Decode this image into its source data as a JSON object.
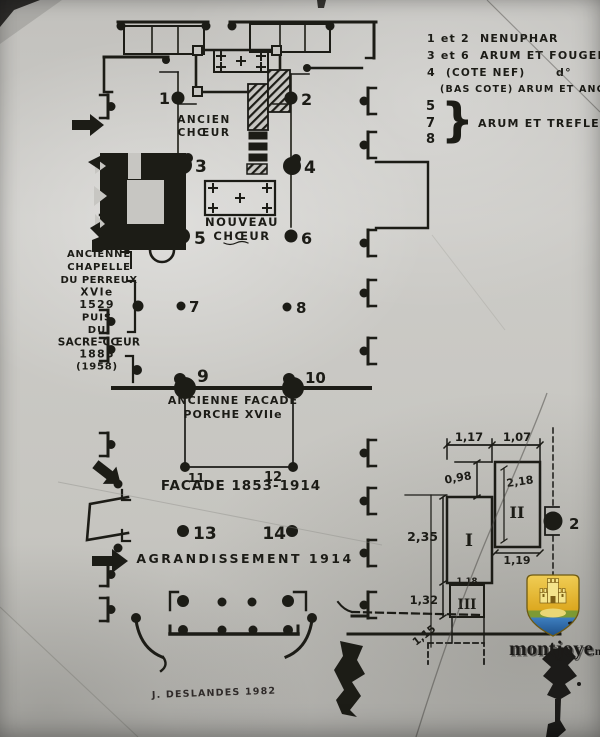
{
  "legend": {
    "row1_nums": "1 et 2",
    "row1_label": "NENUPHAR",
    "row2_nums": "3 et 6",
    "row2_label": "ARUM ET FOUGERE",
    "row3_nums": "4",
    "row3_label": "(COTE NEF)",
    "row3_dito": "d°",
    "row4_label": "(BAS COTE) ARUM ET ANCOLIE",
    "group_num_5": "5",
    "group_num_7": "7",
    "group_num_8": "8",
    "group_brace": "}",
    "group_label": "ARUM ET TREFLE"
  },
  "plan": {
    "pillar_labels": [
      "1",
      "2",
      "3",
      "4",
      "5",
      "6",
      "7",
      "8",
      "9",
      "10",
      "11",
      "12",
      "13",
      "14"
    ],
    "areas": {
      "ancien_1": "ANCIEN",
      "ancien_2": "CHŒUR",
      "nouveau_1": "NOUVEAU",
      "nouveau_2": "CHŒUR",
      "porche_1": "ANCIENNE FACADE",
      "porche_2": "PORCHE XVIIe",
      "facade": "FACADE 1853-1914",
      "agrandissement": "AGRANDISSEMENT 1914"
    },
    "chapelle": [
      "ANCIENNE",
      "CHAPELLE",
      "DU PERREUX",
      "XVIe",
      "1529",
      "PUIS",
      "DU",
      "SACRE-CŒUR",
      "1885",
      "(1958)"
    ],
    "signature": "J. DESLANDES 1982"
  },
  "detail": {
    "dim_117": "1,17",
    "dim_107": "1,07",
    "dim_098": "0,98",
    "dim_218": "2,18",
    "dim_119": "1,19",
    "dim_235": "2,35",
    "dim_132": "1,32",
    "dim_118": "1,18",
    "dim_115": "1,15",
    "base_1": "I",
    "base_2": "II",
    "base_3": "III",
    "pillar_label": "2"
  },
  "watermark": {
    "site": "montjoye",
    "tld": ".net",
    "shield_number": "2"
  },
  "colors": {
    "ink": "#1c1b19",
    "paper": "#c7c6c2",
    "shield_gold": "#e3b52d",
    "shield_green": "#7d9a34",
    "shield_blue": "#2e6cab",
    "watermark_text": "#edebe2"
  }
}
